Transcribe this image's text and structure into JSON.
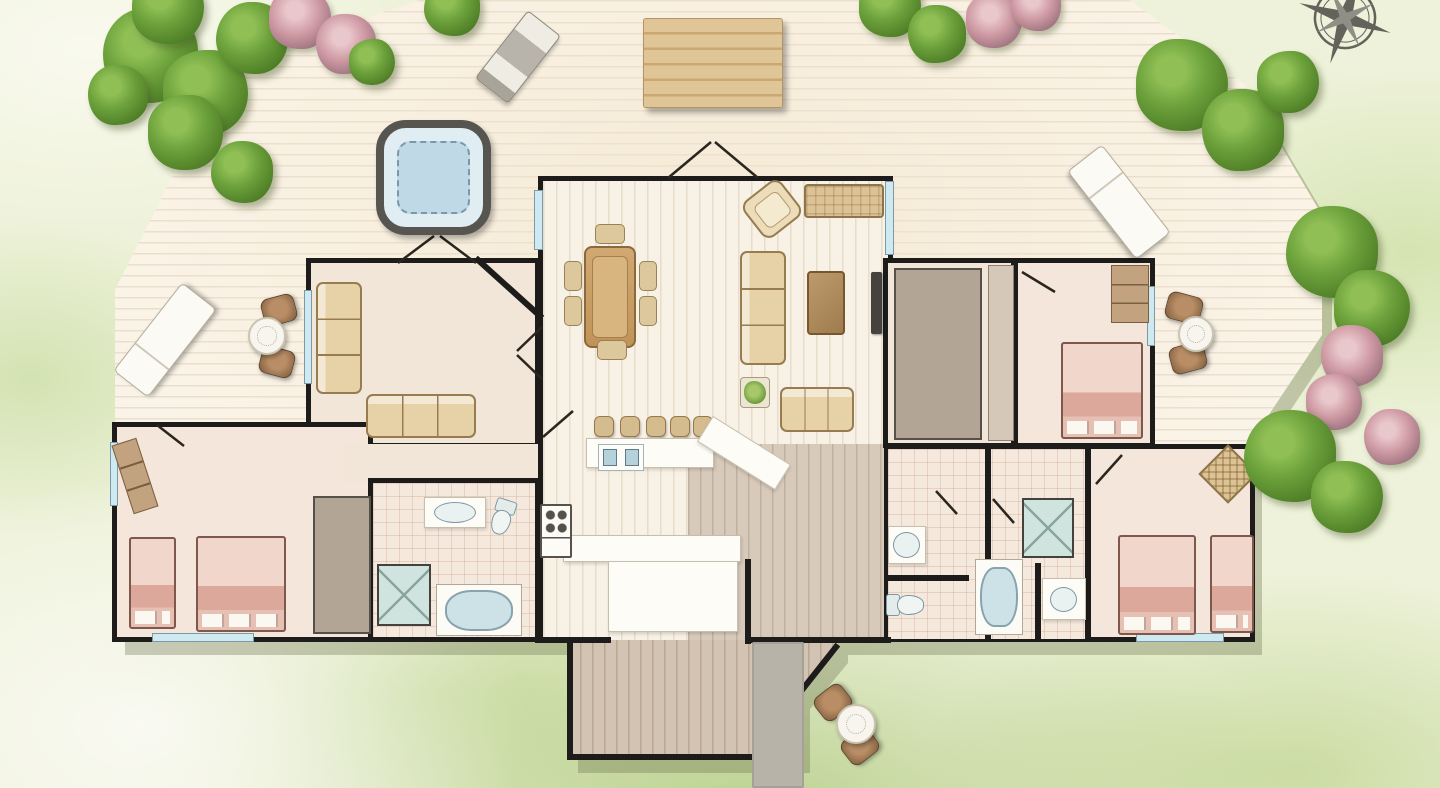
{
  "scene": {
    "width": 1440,
    "height": 788,
    "description": "watercolor-style top-down floor plan of a house with wrap-around wooden deck, lawn, trees and flowering bushes"
  },
  "palette": {
    "wall": "#1d1c1a",
    "deck": "#faf4e8",
    "lawn": "#eef2da",
    "lawn_dark": "#b9d48a",
    "water": "#c2dbe7",
    "window": "#cfe9f0",
    "bed_pink": "#e6bdb2",
    "furniture_tan": "#ddc89e",
    "white_fixture": "#fdfcf7",
    "stone_path": "#b7b3a9",
    "tree_green": "#5f9133",
    "bush_pink": "#cf9aa4",
    "compass_gray": "#63635c"
  },
  "rooms": [
    {
      "id": "living-dining",
      "x": 538,
      "y": 176,
      "w": 355,
      "h": 268,
      "floor": "plank",
      "b": "tlr"
    },
    {
      "id": "den",
      "x": 306,
      "y": 258,
      "w": 234,
      "h": 190,
      "floor": "plain",
      "b": "tlrb"
    },
    {
      "id": "bedroom-left",
      "x": 112,
      "y": 422,
      "w": 261,
      "h": 220,
      "floor": "bedroom",
      "b": "tlrb"
    },
    {
      "id": "hall-left",
      "x": 344,
      "y": 444,
      "w": 200,
      "h": 38,
      "floor": "plain",
      "b": ""
    },
    {
      "id": "bathroom-left",
      "x": 368,
      "y": 478,
      "w": 172,
      "h": 164,
      "floor": "tile",
      "b": "tlrb"
    },
    {
      "id": "kitchen-hall",
      "x": 538,
      "y": 440,
      "w": 350,
      "h": 202,
      "floor": "plank",
      "b": "lr"
    },
    {
      "id": "entry-hall",
      "x": 688,
      "y": 444,
      "w": 198,
      "h": 196,
      "floor": "entry",
      "b": ""
    },
    {
      "id": "entry-extension",
      "x": 568,
      "y": 640,
      "w": 270,
      "h": 120,
      "floor": "ext",
      "b": "",
      "clip": "polygon(0px 0px, 270px 0px, 270px 10px, 232px 56px, 232px 120px, 0px 120px)"
    },
    {
      "id": "closet-room",
      "x": 883,
      "y": 258,
      "w": 133,
      "h": 190,
      "floor": "plain",
      "b": "tlrb"
    },
    {
      "id": "bedroom-topright",
      "x": 1013,
      "y": 258,
      "w": 142,
      "h": 190,
      "floor": "bedroom",
      "b": "tlrb"
    },
    {
      "id": "south-right-wing",
      "x": 884,
      "y": 444,
      "w": 371,
      "h": 198,
      "floor": "bedroom",
      "b": "tlrb"
    },
    {
      "id": "bathrooms-right",
      "x": 888,
      "y": 449,
      "w": 198,
      "h": 190,
      "floor": "tile",
      "b": ""
    }
  ],
  "windows": [
    {
      "x": 110,
      "y": 442,
      "w": 8,
      "h": 64
    },
    {
      "x": 152,
      "y": 633,
      "w": 102,
      "h": 9
    },
    {
      "x": 304,
      "y": 290,
      "w": 8,
      "h": 94
    },
    {
      "x": 534,
      "y": 190,
      "w": 9,
      "h": 60
    },
    {
      "x": 885,
      "y": 181,
      "w": 9,
      "h": 74
    },
    {
      "x": 1147,
      "y": 286,
      "w": 8,
      "h": 60
    },
    {
      "x": 1136,
      "y": 633,
      "w": 88,
      "h": 9
    },
    {
      "x": 796,
      "y": 692,
      "w": 8,
      "h": 58
    }
  ],
  "furniture": [
    {
      "t": "grill",
      "x": 497,
      "y": 14,
      "w": 42,
      "h": 86,
      "r": 38
    },
    {
      "t": "picnic",
      "x": 643,
      "y": 18,
      "w": 140,
      "h": 90
    },
    {
      "t": "hottub",
      "x": 376,
      "y": 120,
      "w": 115,
      "h": 115
    },
    {
      "t": "lounger",
      "x": 109,
      "y": 318,
      "w": 112,
      "h": 44,
      "r": -52
    },
    {
      "t": "lounger",
      "x": 1063,
      "y": 180,
      "w": 112,
      "h": 44,
      "r": 52
    },
    {
      "t": "chair",
      "x": 262,
      "y": 296,
      "w": 34,
      "h": 28,
      "r": -15
    },
    {
      "t": "chair",
      "x": 260,
      "y": 348,
      "w": 34,
      "h": 28,
      "r": 15
    },
    {
      "t": "rtable",
      "x": 248,
      "y": 317,
      "w": 38,
      "h": 38
    },
    {
      "t": "chair",
      "x": 1166,
      "y": 294,
      "w": 36,
      "h": 28,
      "r": 15
    },
    {
      "t": "chair",
      "x": 1170,
      "y": 344,
      "w": 36,
      "h": 28,
      "r": -15
    },
    {
      "t": "rtable",
      "x": 1178,
      "y": 316,
      "w": 36,
      "h": 36
    },
    {
      "t": "chair",
      "x": 816,
      "y": 688,
      "w": 34,
      "h": 29,
      "r": -38
    },
    {
      "t": "chair",
      "x": 843,
      "y": 732,
      "w": 34,
      "h": 29,
      "r": -38
    },
    {
      "t": "rtable",
      "x": 836,
      "y": 704,
      "w": 40,
      "h": 40
    },
    {
      "t": "path",
      "x": 752,
      "y": 642,
      "w": 52,
      "h": 146
    },
    {
      "t": "dtable",
      "x": 584,
      "y": 246,
      "w": 52,
      "h": 102
    },
    {
      "t": "dchair",
      "x": 595,
      "y": 224,
      "w": 30,
      "h": 20
    },
    {
      "t": "dchair",
      "x": 597,
      "y": 340,
      "w": 30,
      "h": 20
    },
    {
      "t": "dchair",
      "x": 564,
      "y": 261,
      "w": 18,
      "h": 30
    },
    {
      "t": "dchair",
      "x": 564,
      "y": 296,
      "w": 18,
      "h": 30
    },
    {
      "t": "dchair",
      "x": 639,
      "y": 261,
      "w": 18,
      "h": 30
    },
    {
      "t": "dchair",
      "x": 639,
      "y": 296,
      "w": 18,
      "h": 30
    },
    {
      "t": "armchair",
      "x": 748,
      "y": 186,
      "w": 48,
      "h": 46,
      "r": -38
    },
    {
      "t": "bench",
      "x": 804,
      "y": 184,
      "w": 80,
      "h": 34
    },
    {
      "t": "sofa",
      "x": 740,
      "y": 251,
      "w": 46,
      "h": 114,
      "dir": "v"
    },
    {
      "t": "coffee",
      "x": 807,
      "y": 271,
      "w": 38,
      "h": 64
    },
    {
      "t": "tv",
      "x": 871,
      "y": 272,
      "w": 11,
      "h": 62
    },
    {
      "t": "sofa",
      "x": 780,
      "y": 387,
      "w": 74,
      "h": 45,
      "dir": "h"
    },
    {
      "t": "plantt",
      "x": 740,
      "y": 377,
      "w": 30,
      "h": 31
    },
    {
      "t": "sofa",
      "x": 316,
      "y": 282,
      "w": 46,
      "h": 112,
      "dir": "v"
    },
    {
      "t": "sofa",
      "x": 366,
      "y": 394,
      "w": 110,
      "h": 44,
      "dir": "h"
    },
    {
      "t": "stool",
      "x": 594,
      "y": 416,
      "w": 20,
      "h": 21
    },
    {
      "t": "stool",
      "x": 620,
      "y": 416,
      "w": 20,
      "h": 21
    },
    {
      "t": "stool",
      "x": 646,
      "y": 416,
      "w": 20,
      "h": 21
    },
    {
      "t": "stool",
      "x": 670,
      "y": 416,
      "w": 20,
      "h": 21
    },
    {
      "t": "stool",
      "x": 693,
      "y": 416,
      "w": 20,
      "h": 21
    },
    {
      "t": "counter",
      "x": 586,
      "y": 438,
      "w": 128,
      "h": 30
    },
    {
      "t": "counter",
      "x": 698,
      "y": 438,
      "w": 92,
      "h": 30,
      "r": 32
    },
    {
      "t": "counter",
      "x": 563,
      "y": 535,
      "w": 178,
      "h": 27
    },
    {
      "t": "counter",
      "x": 608,
      "y": 561,
      "w": 130,
      "h": 71
    },
    {
      "t": "sink2",
      "x": 598,
      "y": 444,
      "w": 46,
      "h": 27
    },
    {
      "t": "stove",
      "x": 540,
      "y": 504,
      "w": 32,
      "h": 54
    },
    {
      "t": "counter",
      "x": 424,
      "y": 497,
      "w": 62,
      "h": 31
    },
    {
      "t": "sink",
      "x": 434,
      "y": 502,
      "w": 42,
      "h": 21
    },
    {
      "t": "toilet",
      "x": 489,
      "y": 499,
      "w": 27,
      "h": 36,
      "r": 18
    },
    {
      "t": "shower",
      "x": 377,
      "y": 564,
      "w": 54,
      "h": 62
    },
    {
      "t": "tub",
      "x": 436,
      "y": 584,
      "w": 86,
      "h": 52
    },
    {
      "t": "counter",
      "x": 888,
      "y": 526,
      "w": 38,
      "h": 38
    },
    {
      "t": "sink",
      "x": 893,
      "y": 532,
      "w": 27,
      "h": 26
    },
    {
      "t": "toilet",
      "x": 891,
      "y": 586,
      "w": 28,
      "h": 38,
      "r": -90
    },
    {
      "t": "shower",
      "x": 1022,
      "y": 498,
      "w": 52,
      "h": 60
    },
    {
      "t": "tub",
      "x": 975,
      "y": 559,
      "w": 48,
      "h": 76
    },
    {
      "t": "counter",
      "x": 1042,
      "y": 578,
      "w": 44,
      "h": 42
    },
    {
      "t": "sink",
      "x": 1050,
      "y": 587,
      "w": 27,
      "h": 25
    },
    {
      "t": "bed",
      "x": 129,
      "y": 537,
      "w": 47,
      "h": 92
    },
    {
      "t": "bed",
      "x": 196,
      "y": 536,
      "w": 90,
      "h": 96
    },
    {
      "t": "dresser",
      "x": 122,
      "y": 440,
      "w": 26,
      "h": 72,
      "r": -18
    },
    {
      "t": "closet",
      "x": 313,
      "y": 496,
      "w": 58,
      "h": 138
    },
    {
      "t": "closet",
      "x": 894,
      "y": 268,
      "w": 88,
      "h": 172
    },
    {
      "t": "closetlight",
      "x": 988,
      "y": 265,
      "w": 26,
      "h": 176
    },
    {
      "t": "bed",
      "x": 1061,
      "y": 342,
      "w": 82,
      "h": 97
    },
    {
      "t": "dresser",
      "x": 1111,
      "y": 265,
      "w": 38,
      "h": 58
    },
    {
      "t": "bed",
      "x": 1118,
      "y": 535,
      "w": 78,
      "h": 100
    },
    {
      "t": "bed",
      "x": 1210,
      "y": 535,
      "w": 44,
      "h": 98
    },
    {
      "t": "wicker",
      "x": 1207,
      "y": 453,
      "w": 42,
      "h": 42,
      "r": 45
    }
  ],
  "trees": [
    {
      "k": "g",
      "x": 150,
      "y": 55,
      "d": 95
    },
    {
      "k": "g",
      "x": 205,
      "y": 92,
      "d": 85
    },
    {
      "k": "g",
      "x": 252,
      "y": 38,
      "d": 72
    },
    {
      "k": "g",
      "x": 168,
      "y": 8,
      "d": 72
    },
    {
      "k": "g",
      "x": 118,
      "y": 95,
      "d": 60
    },
    {
      "k": "g",
      "x": 185,
      "y": 132,
      "d": 75
    },
    {
      "k": "g",
      "x": 242,
      "y": 172,
      "d": 62
    },
    {
      "k": "p",
      "x": 300,
      "y": 18,
      "d": 62
    },
    {
      "k": "p",
      "x": 346,
      "y": 44,
      "d": 60
    },
    {
      "k": "g",
      "x": 372,
      "y": 62,
      "d": 46
    },
    {
      "k": "g",
      "x": 452,
      "y": 8,
      "d": 56
    },
    {
      "k": "g",
      "x": 890,
      "y": 6,
      "d": 62
    },
    {
      "k": "g",
      "x": 937,
      "y": 34,
      "d": 58
    },
    {
      "k": "p",
      "x": 994,
      "y": 20,
      "d": 56
    },
    {
      "k": "p",
      "x": 1036,
      "y": 6,
      "d": 50
    },
    {
      "k": "g",
      "x": 1182,
      "y": 85,
      "d": 92
    },
    {
      "k": "g",
      "x": 1243,
      "y": 130,
      "d": 82
    },
    {
      "k": "g",
      "x": 1288,
      "y": 82,
      "d": 62
    },
    {
      "k": "g",
      "x": 1332,
      "y": 252,
      "d": 92
    },
    {
      "k": "g",
      "x": 1372,
      "y": 308,
      "d": 76
    },
    {
      "k": "p",
      "x": 1352,
      "y": 356,
      "d": 62
    },
    {
      "k": "p",
      "x": 1334,
      "y": 402,
      "d": 56
    },
    {
      "k": "g",
      "x": 1290,
      "y": 456,
      "d": 92
    },
    {
      "k": "g",
      "x": 1347,
      "y": 497,
      "d": 72
    },
    {
      "k": "p",
      "x": 1392,
      "y": 437,
      "d": 56
    }
  ],
  "doors": [
    "M668 178 L711 142 M715 142 L758 178",
    "M398 263 L434 236 M440 236 L476 263",
    "M542 327 L517 351 M517 355 L542 379",
    "M543 437 L573 411",
    "M736 598 L710 614 M710 617 L736 631",
    "M936 491 L957 514",
    "M993 499 L1014 523",
    "M1096 484 L1122 455",
    "M1022 272 L1055 292",
    "M157 425 L184 446"
  ],
  "walls": [
    "M478 260 L540 316",
    "M570 641 L570 757 L798 757 L798 695 L836 647",
    "M748 562 L748 641",
    "M538 640 L608 640",
    "M748 640 L888 640",
    "M988 448 L988 638",
    "M1088 448 L1088 638",
    "M888 578 L966 578",
    "M1038 566 L1038 638"
  ]
}
